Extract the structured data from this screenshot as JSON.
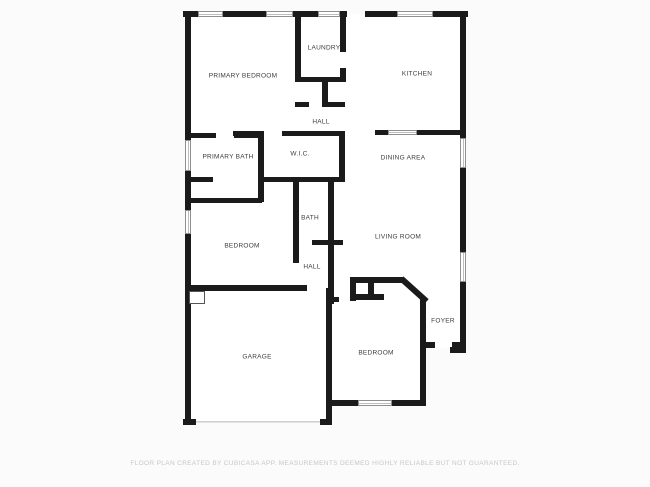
{
  "footer": {
    "disclaimer": "FLOOR PLAN CREATED BY CUBICASA APP. MEASUREMENTS DEEMED HIGHLY RELIABLE BUT NOT GUARANTEED.",
    "y": 460
  },
  "colors": {
    "wall": "#1b1b1b",
    "floor": "#ffffff",
    "background": "#fbfbfb",
    "label_text": "#3c3c3c",
    "disclaimer_text": "#c7c7c7"
  },
  "plan": {
    "floors": [
      [
        188,
        14,
        272,
        275
      ],
      [
        334,
        136,
        126,
        212
      ],
      [
        188,
        287,
        140,
        135
      ],
      [
        332,
        278,
        90,
        124
      ],
      [
        420,
        298,
        40,
        50
      ]
    ],
    "walls": [
      {
        "n": "exterior-top-wall-left",
        "b": [
          183,
          11,
          164,
          6
        ]
      },
      {
        "n": "exterior-top-wall-right",
        "b": [
          365,
          11,
          103,
          6
        ]
      },
      {
        "n": "exterior-left-wall",
        "b": [
          185,
          11,
          6,
          414
        ]
      },
      {
        "n": "exterior-right-wall",
        "b": [
          460,
          11,
          6,
          342
        ]
      },
      {
        "n": "exterior-right-wall-cap",
        "b": [
          450,
          347,
          16,
          6
        ]
      },
      {
        "n": "garage-bottom-left-stub",
        "b": [
          183,
          419,
          13,
          6
        ]
      },
      {
        "n": "garage-bottom-right-stub",
        "b": [
          320,
          419,
          12,
          6
        ]
      },
      {
        "n": "laundry-left-wall",
        "b": [
          295,
          16,
          6,
          66
        ]
      },
      {
        "n": "laundry-right-wall-upper",
        "b": [
          340,
          16,
          6,
          36
        ]
      },
      {
        "n": "laundry-right-wall-lower",
        "b": [
          340,
          68,
          6,
          14
        ]
      },
      {
        "n": "laundry-bottom-wall",
        "b": [
          298,
          77,
          45,
          5
        ]
      },
      {
        "n": "hall-closet-divider",
        "b": [
          322,
          82,
          6,
          25
        ]
      },
      {
        "n": "hall-closet-stub-left",
        "b": [
          295,
          102,
          14,
          5
        ]
      },
      {
        "n": "hall-closet-stub-right",
        "b": [
          322,
          102,
          23,
          5
        ]
      },
      {
        "n": "hall-bottom-wall",
        "b": [
          233,
          131,
          30,
          5
        ]
      },
      {
        "n": "wic-top-wall",
        "b": [
          282,
          131,
          63,
          5
        ]
      },
      {
        "n": "primary-bath-top-wall-left",
        "b": [
          191,
          133,
          25,
          5
        ]
      },
      {
        "n": "primary-bath-top-wall-right",
        "b": [
          234,
          133,
          28,
          5
        ]
      },
      {
        "n": "wic-left-wall",
        "b": [
          258,
          131,
          6,
          71
        ]
      },
      {
        "n": "wic-right-wall",
        "b": [
          339,
          131,
          6,
          51
        ]
      },
      {
        "n": "wic-bottom-wall",
        "b": [
          258,
          177,
          87,
          5
        ]
      },
      {
        "n": "primary-bath-shower-wall",
        "b": [
          191,
          177,
          22,
          5
        ]
      },
      {
        "n": "primary-bath-toilet-stub",
        "b": [
          240,
          198,
          19,
          5
        ]
      },
      {
        "n": "bedroom-top-wall",
        "b": [
          191,
          198,
          71,
          5
        ]
      },
      {
        "n": "bath-left-wall",
        "b": [
          293,
          182,
          6,
          81
        ]
      },
      {
        "n": "bath-right-wall",
        "b": [
          328,
          182,
          6,
          122
        ]
      },
      {
        "n": "bath-bottom-stub",
        "b": [
          312,
          240,
          31,
          5
        ]
      },
      {
        "n": "garage-top-wall",
        "b": [
          185,
          285,
          122,
          6
        ]
      },
      {
        "n": "garage-right-wall",
        "b": [
          326,
          288,
          6,
          137
        ]
      },
      {
        "n": "garage-side-stub",
        "b": [
          332,
          297,
          7,
          5
        ]
      },
      {
        "n": "bedroom2-bottom-wall-left",
        "b": [
          332,
          400,
          26,
          6
        ]
      },
      {
        "n": "bedroom2-bottom-wall-right",
        "b": [
          392,
          400,
          34,
          6
        ]
      },
      {
        "n": "foyer-left-wall",
        "b": [
          420,
          298,
          6,
          105
        ]
      },
      {
        "n": "front-door-stub-left",
        "b": [
          426,
          342,
          9,
          6
        ]
      },
      {
        "n": "front-door-stub-right",
        "b": [
          452,
          342,
          14,
          6
        ]
      },
      {
        "n": "bedroom2-closet-top",
        "b": [
          350,
          277,
          54,
          6
        ]
      },
      {
        "n": "bedroom2-closet-left",
        "b": [
          350,
          277,
          6,
          24
        ]
      },
      {
        "n": "bedroom2-closet-mid",
        "b": [
          368,
          283,
          6,
          17
        ]
      },
      {
        "n": "bedroom2-closet-bottom",
        "b": [
          350,
          294,
          34,
          6
        ]
      },
      {
        "n": "bedroom2-diagonal-wall",
        "b": [
          397,
          287,
          34,
          6
        ],
        "r": 42
      },
      {
        "n": "dining-wall-left-stub",
        "b": [
          375,
          130,
          13,
          5
        ]
      },
      {
        "n": "dining-wall-right",
        "b": [
          417,
          130,
          49,
          5
        ]
      }
    ],
    "windows": [
      {
        "n": "window-top-1",
        "b": [
          198,
          11,
          25,
          6
        ]
      },
      {
        "n": "window-top-2",
        "b": [
          266,
          11,
          27,
          6
        ]
      },
      {
        "n": "window-top-3",
        "b": [
          318,
          11,
          22,
          6
        ]
      },
      {
        "n": "window-top-4",
        "b": [
          397,
          11,
          36,
          6
        ]
      },
      {
        "n": "window-left-primary-bath",
        "b": [
          185,
          140,
          6,
          31
        ]
      },
      {
        "n": "window-left-bedroom",
        "b": [
          185,
          210,
          6,
          24
        ]
      },
      {
        "n": "window-right-dining",
        "b": [
          460,
          138,
          6,
          30
        ]
      },
      {
        "n": "window-right-living",
        "b": [
          460,
          252,
          6,
          30
        ]
      },
      {
        "n": "window-dining-pass",
        "b": [
          388,
          130,
          29,
          5
        ]
      },
      {
        "n": "window-bedroom2-bottom",
        "b": [
          358,
          400,
          34,
          6
        ]
      }
    ],
    "garage_door": [
      196,
      421,
      124
    ],
    "door_swing": [
      189,
      291,
      16,
      13
    ],
    "rooms": [
      {
        "label": "PRIMARY BEDROOM",
        "x": 243,
        "y": 76
      },
      {
        "label": "LAUNDRY",
        "x": 324,
        "y": 48
      },
      {
        "label": "KITCHEN",
        "x": 417,
        "y": 74
      },
      {
        "label": "HALL",
        "x": 321,
        "y": 122
      },
      {
        "label": "PRIMARY BATH",
        "x": 228,
        "y": 157
      },
      {
        "label": "W.I.C.",
        "x": 300,
        "y": 154
      },
      {
        "label": "DINING AREA",
        "x": 403,
        "y": 158
      },
      {
        "label": "BATH",
        "x": 310,
        "y": 218
      },
      {
        "label": "BEDROOM",
        "x": 242,
        "y": 246
      },
      {
        "label": "LIVING ROOM",
        "x": 398,
        "y": 237
      },
      {
        "label": "HALL",
        "x": 312,
        "y": 267
      },
      {
        "label": "GARAGE",
        "x": 257,
        "y": 357
      },
      {
        "label": "BEDROOM",
        "x": 376,
        "y": 353
      },
      {
        "label": "FOYER",
        "x": 443,
        "y": 321
      }
    ]
  }
}
